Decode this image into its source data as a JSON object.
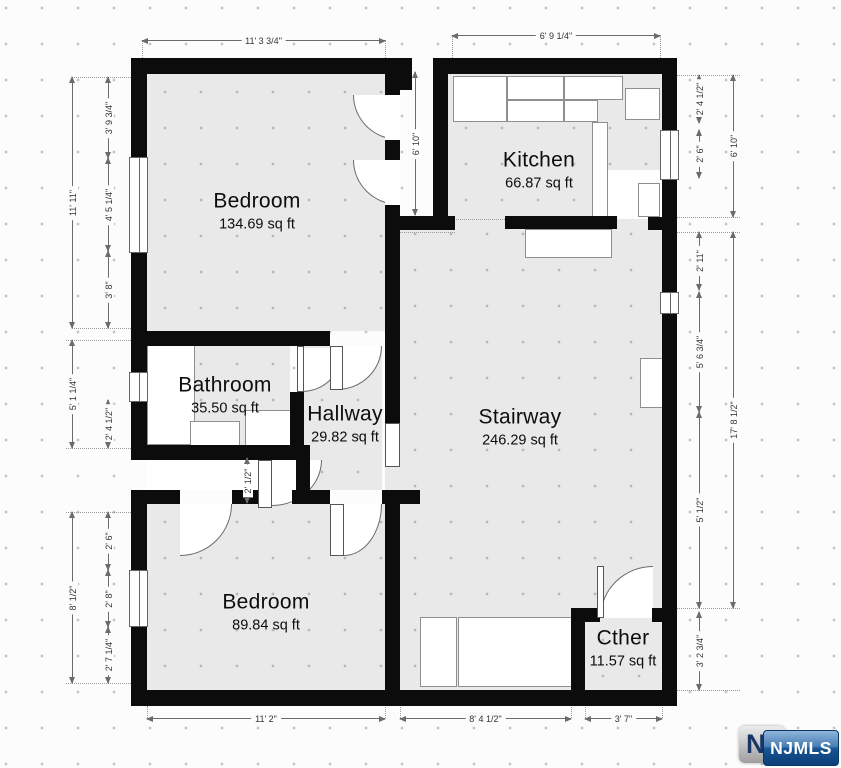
{
  "rooms": [
    {
      "id": "bedroom-1",
      "name": "Bedroom",
      "area": "134.69 sq ft"
    },
    {
      "id": "kitchen",
      "name": "Kitchen",
      "area": "66.87 sq ft"
    },
    {
      "id": "bathroom",
      "name": "Bathroom",
      "area": "35.50 sq ft"
    },
    {
      "id": "hallway",
      "name": "Hallway",
      "area": "29.82 sq ft"
    },
    {
      "id": "stairway",
      "name": "Stairway",
      "area": "246.29 sq ft"
    },
    {
      "id": "bedroom-2",
      "name": "Bedroom",
      "area": "89.84 sq ft"
    },
    {
      "id": "other",
      "name": "Cther",
      "area": "11.57 sq ft"
    }
  ],
  "dimensions": {
    "d_top_bed": "11' 3 3/4\"",
    "d_top_kit": "6' 9 1/4\"",
    "d_l_total1": "11' 11\"",
    "d_l_a": "3' 9 3/4\"",
    "d_l_b": "4' 5 1/4\"",
    "d_l_c": "3' 8\"",
    "d_l_total2": "5' 1 1/4\"",
    "d_l_d": "2' 4 1/2\"",
    "d_l_total3": "8' 1/2\"",
    "d_l_e": "2' 6\"",
    "d_l_f": "2' 8\"",
    "d_l_g": "2' 7 1/4\"",
    "d_mid": "6' 10\"",
    "d_closet": "2' 1/2\"",
    "d_r_a": "2' 4 1/2\"",
    "d_r_b": "2' 6\"",
    "d_r_kit": "6' 10\"",
    "d_r_c": "2' 11\"",
    "d_r_d": "5' 6 3/4\"",
    "d_r_total": "17' 8 1/2\"",
    "d_r_e": "5' 1/2\"",
    "d_r_f": "3' 2 3/4\"",
    "d_b_bed": "11' 2\"",
    "d_b_stair": "8' 4 1/2\"",
    "d_b_other": "3' 7\""
  },
  "watermark": {
    "initial": "N",
    "text": "NJMLS"
  }
}
